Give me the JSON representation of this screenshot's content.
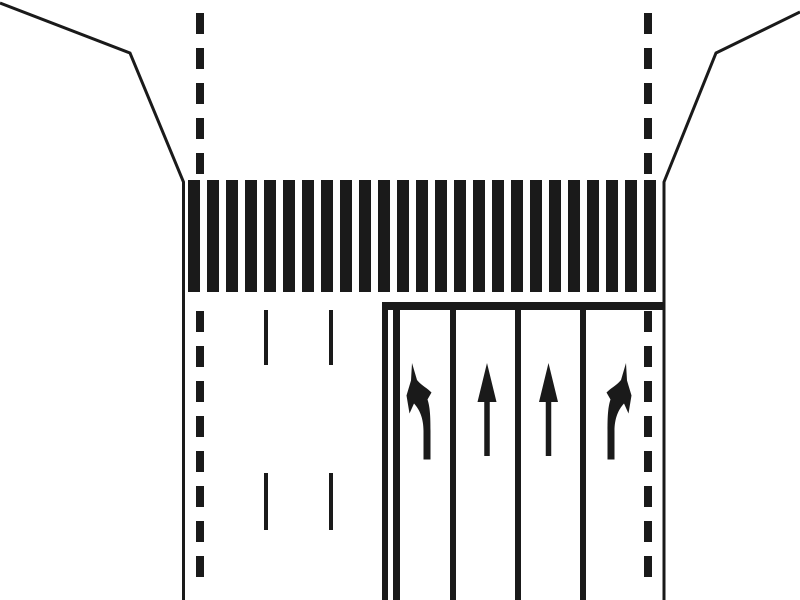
{
  "canvas": {
    "width": 800,
    "height": 600,
    "background_color": "#ffffff",
    "ink_color": "#1a1a1a"
  },
  "diagram": {
    "kind": "road-intersection-approach-markings",
    "road_edges": {
      "stroke_width": 3,
      "left_points": [
        [
          0,
          3
        ],
        [
          130,
          53
        ],
        [
          183.5,
          182
        ],
        [
          183.5,
          600
        ]
      ],
      "right_points": [
        [
          800,
          12
        ],
        [
          716,
          53
        ],
        [
          664,
          182
        ],
        [
          664,
          600
        ]
      ]
    },
    "center_dashed_lines": {
      "stroke_width": 8,
      "dash_length": 21,
      "gap_length": 14,
      "lines": [
        {
          "id": "left-centerline",
          "x": 200,
          "segments": [
            {
              "y1": 13,
              "y2": 180
            },
            {
              "y1": 311,
              "y2": 583
            }
          ]
        },
        {
          "id": "right-centerline",
          "x": 648,
          "segments": [
            {
              "y1": 13,
              "y2": 180
            },
            {
              "y1": 311,
              "y2": 583
            }
          ]
        }
      ]
    },
    "crosswalk": {
      "style": "zebra",
      "x_start": 188,
      "bar_width": 12,
      "bar_spacing": 19,
      "bar_count": 25,
      "y_top": 180,
      "bar_height": 112
    },
    "stop_line": {
      "x": 382,
      "y": 302,
      "width": 281,
      "height": 8
    },
    "approach_lane_boundary": {
      "y": 302,
      "height": 298,
      "lines": [
        {
          "x": 382,
          "width": 6
        },
        {
          "x": 393,
          "width": 7
        }
      ]
    },
    "lane_dividers": {
      "xs": [
        450,
        515,
        580
      ],
      "width": 6,
      "y": 310,
      "height": 290
    },
    "opposing_lane_dashes": {
      "width": 4,
      "dashes": [
        {
          "x": 264,
          "y": 310,
          "h": 55
        },
        {
          "x": 329,
          "y": 310,
          "h": 55
        },
        {
          "x": 264,
          "y": 473,
          "h": 57
        },
        {
          "x": 329,
          "y": 473,
          "h": 57
        }
      ]
    },
    "lane_arrows": {
      "straight_params": {
        "apex_y": 363,
        "head_base_y": 402,
        "head_half_width": 9.5,
        "shaft_half_width": 2.75,
        "shaft_bottom_y": 456
      },
      "turn_path": "M 412,363 L 417,380 C 421,385 427,388 431.5,392.5 L 427.5,399.5 C 430,407 430.5,416 430.5,431 L 430.5,459.5 L 423.5,459.5 L 423.5,431 C 423.5,418 419.5,409.5 414,403.5 L 409.5,413.5 L 406.5,395.5 L 411,380.5 Z",
      "mirror_sum": 1038,
      "arrows": [
        {
          "lane": 1,
          "direction": "left-turn"
        },
        {
          "lane": 2,
          "direction": "straight",
          "cx": 487
        },
        {
          "lane": 3,
          "direction": "straight",
          "cx": 548.5
        },
        {
          "lane": 4,
          "direction": "right-turn"
        }
      ]
    }
  }
}
